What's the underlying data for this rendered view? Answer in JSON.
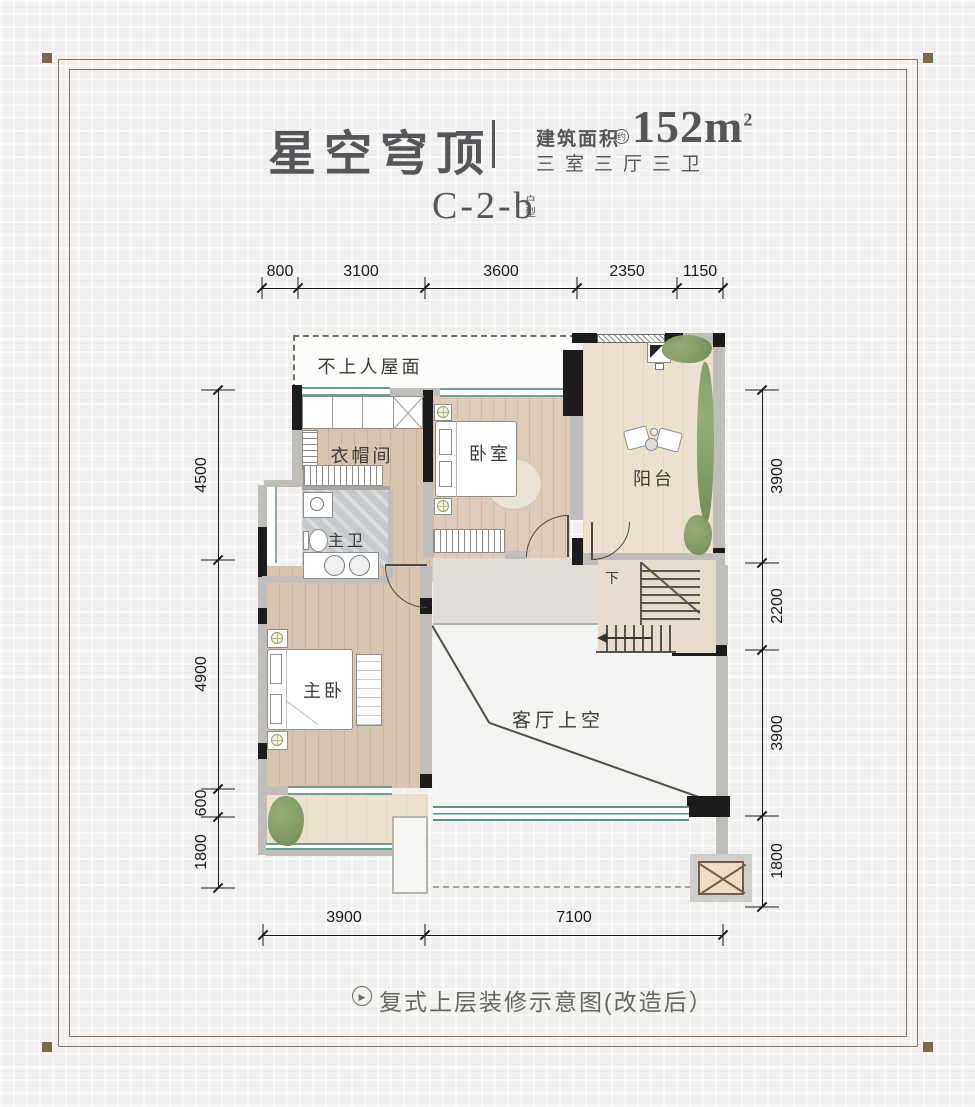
{
  "header": {
    "title": "星空穹顶",
    "area_label": "建筑面积",
    "area_approx": "约",
    "area_value": "152m",
    "area_exponent": "2",
    "spec": "三室三厅三卫",
    "unit_code": "C-2-b",
    "unit_label_chars": [
      "户",
      "型"
    ]
  },
  "dimensions": {
    "top": [
      "800",
      "3100",
      "3600",
      "2350",
      "1150"
    ],
    "left": [
      "4500",
      "4900",
      "600",
      "1800"
    ],
    "right": [
      "3900",
      "2200",
      "3900",
      "1800"
    ],
    "bottom": [
      "3900",
      "7100"
    ]
  },
  "rooms": {
    "roof": "不上人屋面",
    "cloakroom": "衣帽间",
    "bedroom": "卧室",
    "balcony": "阳台",
    "master_bath": "主卫",
    "master_bedroom": "主卧",
    "living_void": "客厅上空",
    "stairs_down": "下"
  },
  "caption": {
    "icon_glyph": "▶",
    "text": "复式上层装修示意图(改造后）"
  },
  "colors": {
    "wall_black": "#1c1c1c",
    "wall_gray": "#bfbeba",
    "window_teal": "#6f9c96",
    "wood": "#d9c6b1",
    "balcony_cream": "#ebe0cb",
    "marble_gray": "#c6c9cb",
    "plant_green": "#7d9565",
    "frame_brown": "#8a775a",
    "title_gray": "#56565a"
  }
}
